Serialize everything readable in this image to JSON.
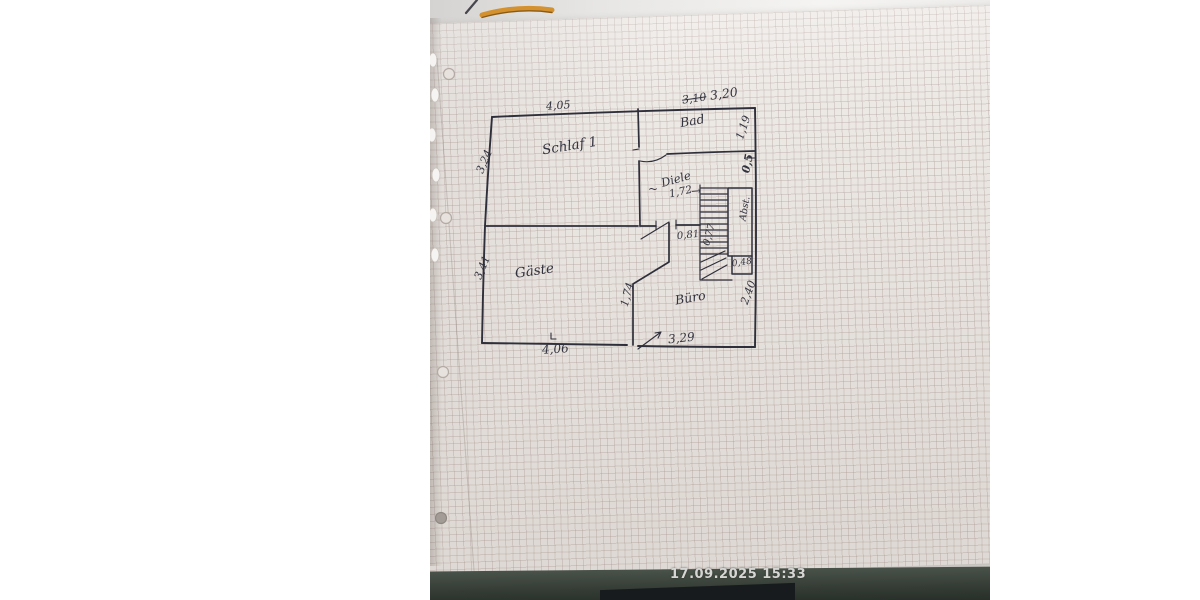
{
  "photo": {
    "timestamp": "17.09.2025 15:33"
  },
  "plan": {
    "rooms": {
      "schlaf": "Schlaf 1",
      "bad": "Bad",
      "diele": "Diele",
      "gaeste": "Gäste",
      "buero": "Büro",
      "abstell": "Abst."
    },
    "dims": {
      "top_left": "4,05",
      "top_right_old": "3,10",
      "top_right": "3,20",
      "right_bad": "1,19",
      "right_mid": "0,5",
      "right_buero": "2,40",
      "left_schlaf": "3,24",
      "left_gaeste": "3,41",
      "diele": "1,72",
      "diele_arrow": "→",
      "diele_tilde": "~",
      "door": "0,81",
      "stairs": "0,77",
      "niche": "0,48",
      "buero_left": "1,74",
      "bottom_left": "4,06",
      "bottom_right": "3,29"
    }
  },
  "colors": {
    "ink": "#2f2f3b",
    "paper": "#ece8e4",
    "grid_line": "#cdbdb9",
    "table": "#39423a",
    "folder_accent": "#d49130",
    "timestamp_text": "#d6d6d4"
  }
}
